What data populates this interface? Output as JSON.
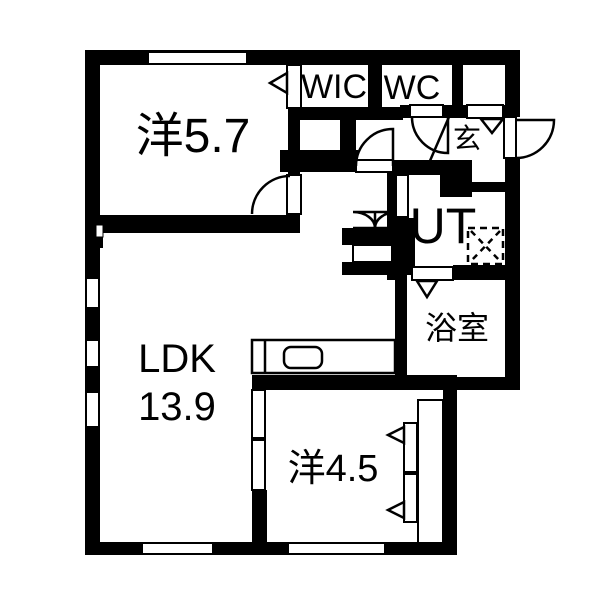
{
  "title": "apartment-floor-plan",
  "colors": {
    "wall": "#000000",
    "background": "#ffffff",
    "line": "#000000"
  },
  "rooms": {
    "yo57": {
      "label": "洋5.7"
    },
    "wic": {
      "label": "WIC"
    },
    "wc": {
      "label": "WC"
    },
    "genkan": {
      "label": "玄"
    },
    "ut": {
      "label": "UT"
    },
    "bath": {
      "label": "浴室"
    },
    "ldk": {
      "label_line1": "LDK",
      "label_line2": "13.9"
    },
    "yo45": {
      "label": "洋4.5"
    }
  }
}
